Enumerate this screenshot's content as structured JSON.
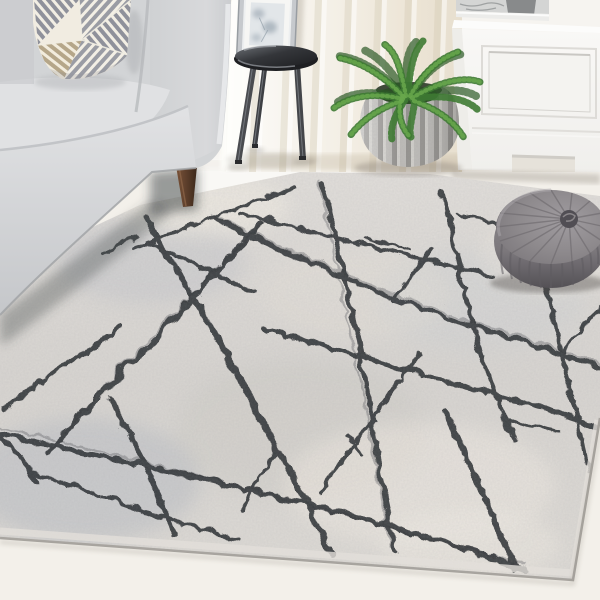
{
  "scene": {
    "description": "Bright living room corner staged around a grey abstract area rug",
    "objects": {
      "wall": "White wall with sheer ivory curtain",
      "window_light": "Soft daylight glow behind the sofa arm",
      "framed_art": "Silver-framed botanical print leaning against the wall",
      "side_table": "Round dark-glass tripod side table",
      "sofa": "Light grey upholstered sofa with walnut tapered leg",
      "throw_pillow": "Cream and grey geometric striped cushion",
      "fern_plant": "Boston fern",
      "planter": "Ribbed grey stone planter pot",
      "cabinet": "White panelled storage cabinet",
      "marble_tray": "Grey marble tray on the cabinet top",
      "pouf": "Round pleated grey velvet pouf",
      "area_rug": "Ivory-grey distressed rug with charcoal abstract crosshatch lines",
      "floor": "Pale whitewashed floor"
    },
    "palette": {
      "wall": "#f7f5f1",
      "curtain_shade": "#e9e1d3",
      "floor": "#f3f0ea",
      "rug_light": "#e7e4df",
      "rug_mid": "#d6d3cf",
      "rug_patch_cool": "#c3c6c9",
      "rug_line": "#2b2d30",
      "sofa": "#d6d7d9",
      "sofa_shadow": "#b3b5b8",
      "pillow_cream": "#f1ece1",
      "pillow_grey": "#90929c",
      "pillow_tan": "#b5a689",
      "table": "#222326",
      "wood_leg": "#5f4330",
      "fern_green": "#47853a",
      "pot": "#b4b2ae",
      "cabinet": "#f8f7f5",
      "tray_marble": "#cdcecd",
      "pouf": "#8b8789",
      "pouf_shadow": "#5e5a5f"
    }
  }
}
